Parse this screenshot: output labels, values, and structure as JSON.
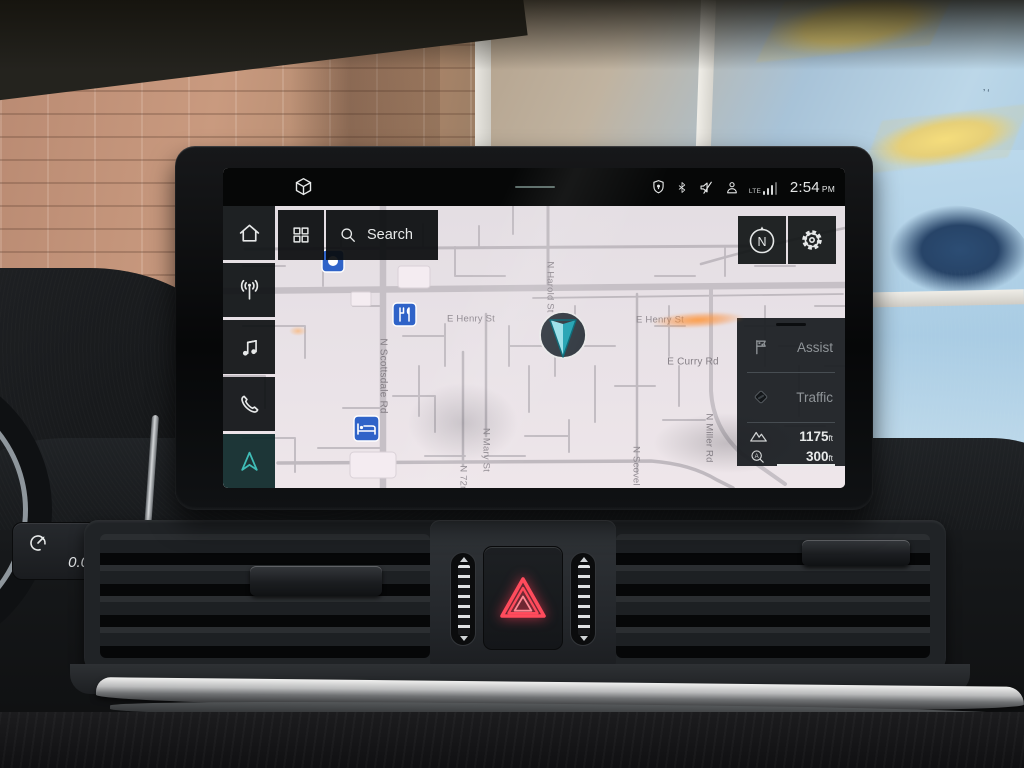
{
  "colors": {
    "accent_teal": "#3fbdb7",
    "hazard_red": "#ff4b5c",
    "map_background": "#e7e1e6",
    "map_road": "#c2bcc2",
    "poi_blue": "#2f63c8",
    "panel_background": "#1c2024",
    "status_text": "#e4e6e6"
  },
  "status_bar": {
    "time_value": "2:54",
    "time_period": "PM",
    "lte_label": "LTE",
    "left_icon": "3d-map-view",
    "right_icons": [
      "privacy-location",
      "bluetooth",
      "sound-muted",
      "profile",
      "lte-signal"
    ]
  },
  "sidebar": {
    "items": [
      {
        "id": "home",
        "icon": "home-icon",
        "active": false
      },
      {
        "id": "radio",
        "icon": "radio-antenna-icon",
        "active": false
      },
      {
        "id": "media",
        "icon": "music-note-icon",
        "active": false
      },
      {
        "id": "phone",
        "icon": "phone-icon",
        "active": false
      },
      {
        "id": "navigation",
        "icon": "nav-arrow-icon",
        "active": true
      }
    ]
  },
  "search": {
    "label": "Search"
  },
  "map_controls": {
    "compass_label": "N",
    "settings_icon": "gear-icon"
  },
  "side_panel": {
    "assist_label": "Assist",
    "traffic_label": "Traffic",
    "elevation_value": "1175",
    "elevation_unit": "ft",
    "scale_value": "300",
    "scale_unit": "ft"
  },
  "map": {
    "streets": [
      {
        "name": "E Henry St"
      },
      {
        "name": "E Henry St"
      },
      {
        "name": "N Harold St"
      },
      {
        "name": "E Curry Rd"
      },
      {
        "name": "N Scottsdale Rd"
      },
      {
        "name": "N Mary St"
      },
      {
        "name": "N 72nd Pl"
      },
      {
        "name": "N Scovel St"
      },
      {
        "name": "N Miller Rd"
      },
      {
        "name": "E Gilbert Dr"
      }
    ],
    "pois": [
      {
        "type": "restaurant"
      },
      {
        "type": "hotel"
      },
      {
        "type": "poi"
      }
    ]
  },
  "console": {
    "trip_value": "0.0"
  }
}
